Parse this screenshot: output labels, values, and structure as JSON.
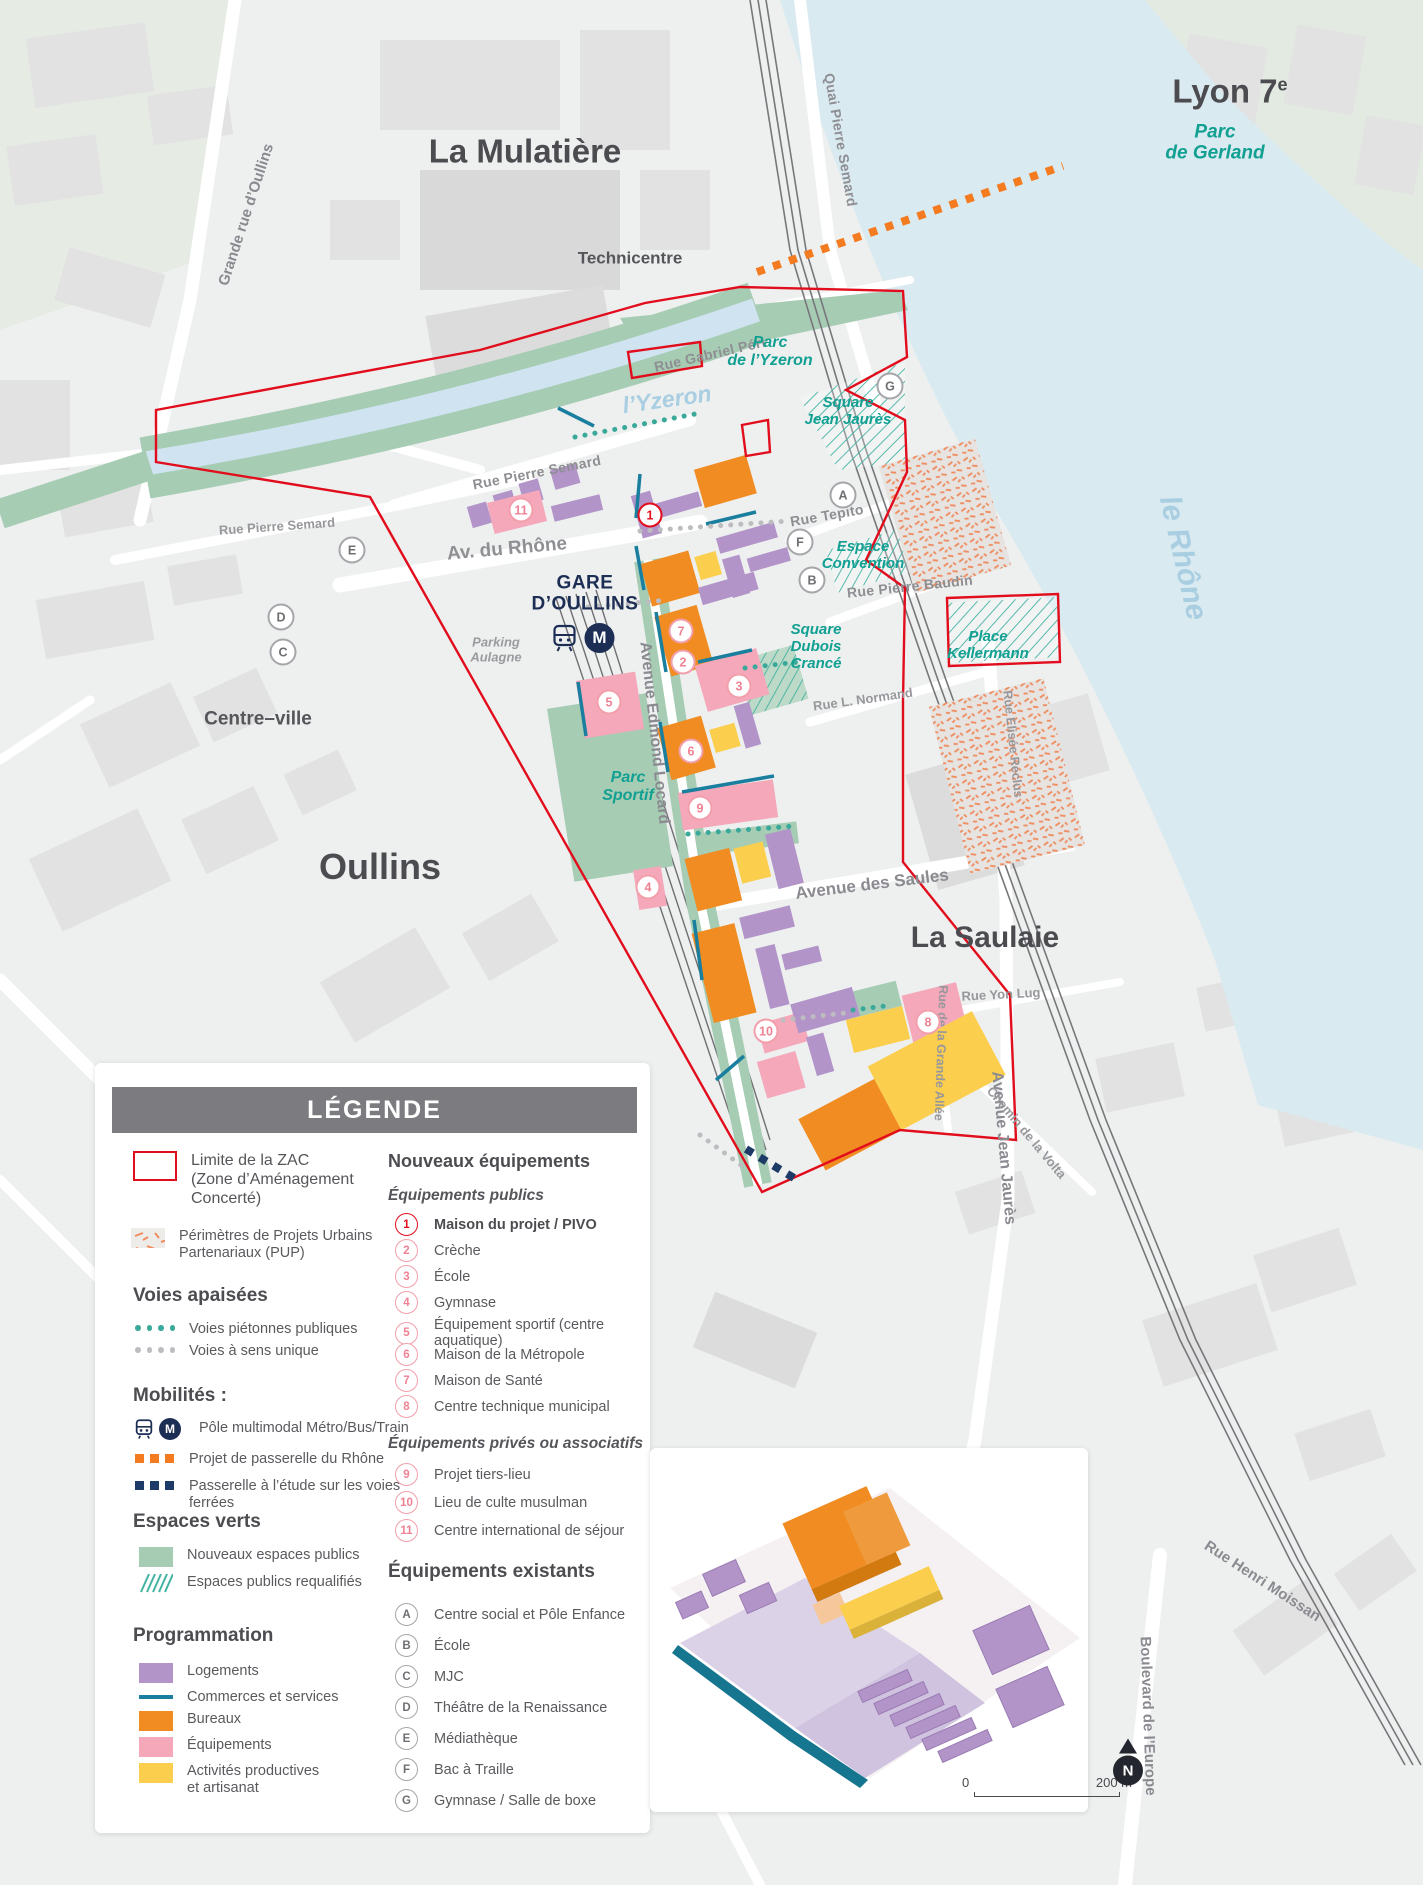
{
  "legend": {
    "title": "LÉGENDE",
    "zac_label": "Limite de la ZAC\n(Zone d’Aménagement\nConcerté)",
    "pup_label": "Périmètres de Projets Urbains\nPartenariaux (PUP)",
    "voies": {
      "title": "Voies apaisées",
      "pietonnes": "Voies piétonnes publiques",
      "sens_unique": "Voies à sens unique"
    },
    "mobilites": {
      "title": "Mobilités :",
      "multimodal": "Pôle multimodal Métro/Bus/Train",
      "passerelle_rhone": "Projet de passerelle du Rhône",
      "passerelle_voies": "Passerelle à l’étude sur les voies\nferrées"
    },
    "espaces_verts": {
      "title": "Espaces verts",
      "nouveaux": "Nouveaux espaces publics",
      "requalifies": "Espaces publics requalifiés"
    },
    "programmation": {
      "title": "Programmation",
      "items": [
        {
          "label": "Logements",
          "color": "#b294c8"
        },
        {
          "label": "Commerces et services",
          "color": "#1a7f9e"
        },
        {
          "label": "Bureaux",
          "color": "#f08c21"
        },
        {
          "label": "Équipements",
          "color": "#f4a8ba"
        },
        {
          "label": "Activités productives\net artisanat",
          "color": "#fbce4d"
        }
      ]
    },
    "nouveaux_equipements": {
      "title": "Nouveaux équipements",
      "publics": {
        "title": "Équipements publics",
        "items": [
          {
            "num": "1",
            "label": "Maison du projet / PIVO"
          },
          {
            "num": "2",
            "label": "Crèche"
          },
          {
            "num": "3",
            "label": "École"
          },
          {
            "num": "4",
            "label": "Gymnase"
          },
          {
            "num": "5",
            "label": "Équipement sportif (centre aquatique)"
          },
          {
            "num": "6",
            "label": "Maison de la Métropole"
          },
          {
            "num": "7",
            "label": "Maison de Santé"
          },
          {
            "num": "8",
            "label": "Centre technique municipal"
          }
        ]
      },
      "prives": {
        "title": "Équipements privés ou associatifs",
        "items": [
          {
            "num": "9",
            "label": "Projet tiers-lieu"
          },
          {
            "num": "10",
            "label": "Lieu de culte musulman"
          },
          {
            "num": "11",
            "label": "Centre international de séjour"
          }
        ]
      }
    },
    "existants": {
      "title": "Équipements existants",
      "items": [
        {
          "letter": "A",
          "label": "Centre social et Pôle Enfance"
        },
        {
          "letter": "B",
          "label": "École"
        },
        {
          "letter": "C",
          "label": "MJC"
        },
        {
          "letter": "D",
          "label": "Théâtre de la Renaissance"
        },
        {
          "letter": "E",
          "label": "Médiathèque"
        },
        {
          "letter": "F",
          "label": "Bac à Traille"
        },
        {
          "letter": "G",
          "label": "Gymnase / Salle de boxe"
        }
      ]
    }
  },
  "map": {
    "labels": {
      "grande_rue_oullins": "Grande rue d’Oullins",
      "la_mulatiere": "La Mulatière",
      "technicentre": "Technicentre",
      "quai_pierre_semard": "Quai Pierre Semard",
      "lyon7": "Lyon 7",
      "lyon7_sup": "e",
      "parc_gerland": "Parc\nde Gerland",
      "le_rhone": "le Rhône",
      "rue_gabriel_peri": "Rue Gabriel Péri",
      "parc_yzeron": "Parc\nde l’Yzeron",
      "l_yzeron": "l’Yzeron",
      "square_jean_jaures": "Square\nJean Jaurès",
      "rue_pierre_semard_a": "Rue Pierre Semard",
      "rue_pierre_semard_b": "Rue Pierre Semard",
      "av_du_rhone": "Av. du Rhône",
      "rue_tepito": "Rue Tepito",
      "espace_convention": "Espace\nConvention",
      "rue_pierre_baudin": "Rue Pierre Baudin",
      "place_kellermann": "Place\nKellermann",
      "gare_oullins": "GARE\nD’OULLINS",
      "parking_aulagne": "Parking\nAulagne",
      "square_dubois": "Square\nDubois\nCrancé",
      "rue_l_normand": "Rue L. Normand",
      "rue_elisee_reclus": "Rue Elisée Reclus",
      "centre_ville": "Centre–ville",
      "oullins": "Oullins",
      "parc_sportif": "Parc\nSportif",
      "avenue_edmond_locard": "Avenue Edmond Locard",
      "avenue_des_saules": "Avenue des Saules",
      "la_saulaie": "La Saulaie",
      "avenue_jean_jaures": "Avenue Jean Jaurès",
      "rue_yon_lug": "Rue Yon Lug",
      "rue_grande_allee": "Rue de la Grande Allée",
      "chemin_volta": "Chemin de la Volta",
      "rue_henri_moissan": "Rue Henri Moissan",
      "boulevard_europe": "Boulevard de  l’Europe"
    },
    "markers": {
      "public": [
        "1",
        "2",
        "3",
        "4",
        "5",
        "6",
        "7",
        "8",
        "9",
        "10",
        "11"
      ],
      "existing": [
        "A",
        "B",
        "C",
        "D",
        "E",
        "F",
        "G"
      ]
    },
    "metro_m": "M"
  },
  "scale": {
    "start": "0",
    "end": "200 m"
  },
  "north": "N",
  "colors": {
    "zac_red": "#e20d1c",
    "teal_text": "#11a092",
    "navy": "#1d2e55",
    "water": "#d9eaf0",
    "green_space": "#a7ccb4",
    "logements_purple": "#b294c8",
    "commerces_teal": "#1a7f9e",
    "bureaux_orange": "#f08c21",
    "equipements_pink": "#f4a8ba",
    "activites_yellow": "#fbce4d",
    "passerelle_orange": "#f47b20",
    "passerelle_navy": "#1d3b66"
  }
}
